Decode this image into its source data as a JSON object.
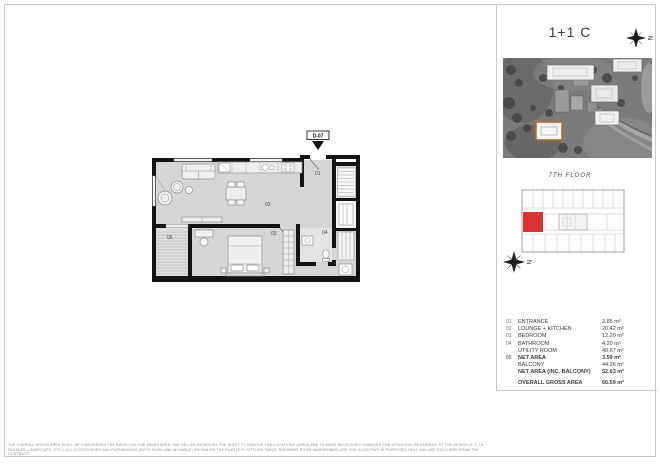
{
  "header": {
    "unit_title": "1+1 C",
    "compass_label": "N"
  },
  "site_photo": {
    "image_kind": "aerial-site-photo",
    "highlighted_building_color": "#a8703a"
  },
  "key_plan": {
    "floor_label": "7TH FLOOR",
    "compass_label": "N",
    "unit_highlight_color": "#d93434"
  },
  "floor_plan": {
    "door_tag": "D-07",
    "room_labels": {
      "entrance": "01",
      "lounge_kitchen": "02",
      "bedroom": "03",
      "bathroom": "04",
      "balcony": "05"
    }
  },
  "area_table": {
    "rows": [
      {
        "num": "01",
        "label": "ENTRANCE",
        "value": "3.85 m²",
        "bold": false,
        "spaced": false
      },
      {
        "num": "02",
        "label": "LOUNGE + KITCHEN",
        "value": "20.42 m²",
        "bold": false,
        "spaced": false
      },
      {
        "num": "03",
        "label": "BEDROOM",
        "value": "12.20 m²",
        "bold": false,
        "spaced": false
      },
      {
        "num": "04",
        "label": "BATHROOM",
        "value": "4.20 m²",
        "bold": false,
        "spaced": false
      },
      {
        "num": "",
        "label": "UTILITY ROOM",
        "value": "40.67 m²",
        "bold": false,
        "spaced": false
      },
      {
        "num": "05",
        "label": "NET AREA",
        "value": "3.59 m²",
        "bold": true,
        "spaced": false
      },
      {
        "num": "",
        "label": "BALCONY",
        "value": "44.26 m²",
        "bold": false,
        "spaced": false
      },
      {
        "num": "",
        "label": "NET AREA (INC. BALCONY)",
        "value": "52.63 m²",
        "bold": true,
        "spaced": false
      },
      {
        "num": "",
        "label": "OVERALL GROSS AREA",
        "value": "66.59 m²",
        "bold": true,
        "spaced": true
      }
    ]
  },
  "disclaimer": {
    "line1": "THE OVERALL GROSS AREA SHALL BE CONSIDERED THE BASIS FOR THE SALES AREA. THE SELLER RESERVES THE RIGHT TO REMOVE THE LOCATIONS (AREA) AND TO MAKE NECESSARY CHANGES FOR SITUATION, REGARDING TO THE DESIGN (E.G. IN",
    "line2": "FACADES, LANDSCAPE, ETC.). ALL ACCESSORIES AND FURNISHINGS (BOTH FIXED AND MOVABLE) SHOWN ON THE PLAN (E.G. KITCHEN TABLE, DRESSING ROOM WARDROBES) ARE FOR ILLUSTRATIVE PURPOSES ONLY AND ARE EXCLUDED FROM THE CONTRACT"
  }
}
